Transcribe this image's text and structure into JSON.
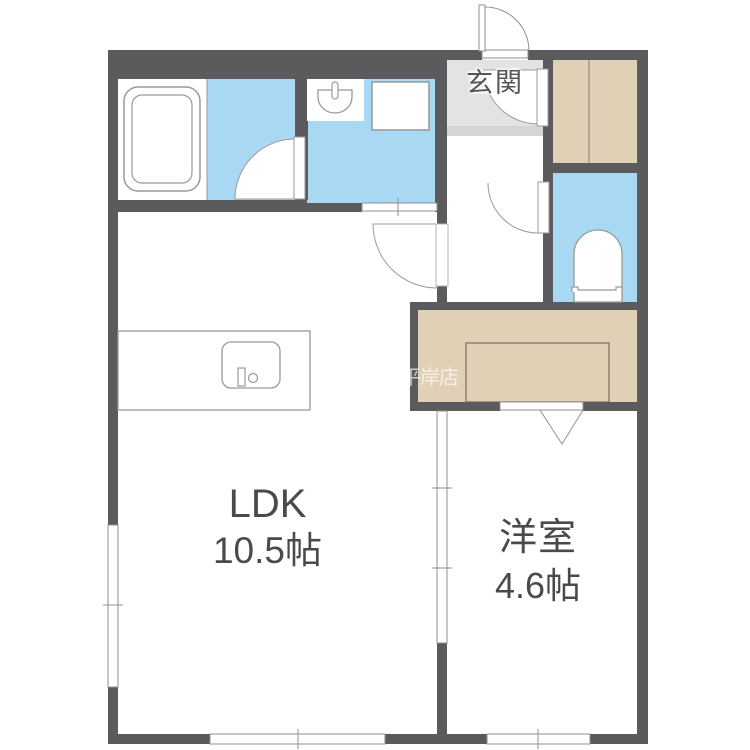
{
  "plan": {
    "watermark": "平岸店",
    "rooms": {
      "entrance": {
        "label": "玄関"
      },
      "ldk": {
        "label": "LDK",
        "size": "10.5帖"
      },
      "western_room": {
        "label": "洋室",
        "size": "4.6帖"
      }
    }
  },
  "colors": {
    "wall": "#5b5b5d",
    "water_area_floor": "#a9d9f2",
    "bath_floor": "#ffffff",
    "entrance_floor": "#e3e3e3",
    "entrance_step": "#d5d5d5",
    "closet_floor": "#e0d0b5",
    "fixture_outline": "#8f8f8f",
    "label_text": "#4a4a4a"
  },
  "icons": {
    "bathtub-icon": "double rounded rectangle",
    "washbasin-icon": "bowl with faucet",
    "washing-machine-icon": "outlined square",
    "toilet-icon": "arched bowl with tank",
    "kitchen-sink-icon": "rounded sink with faucet and knob",
    "door-swing-icon": "quarter-circle arc with leaf",
    "folding-door-icon": "downward triangle",
    "window-icon": "white band with center tick"
  }
}
